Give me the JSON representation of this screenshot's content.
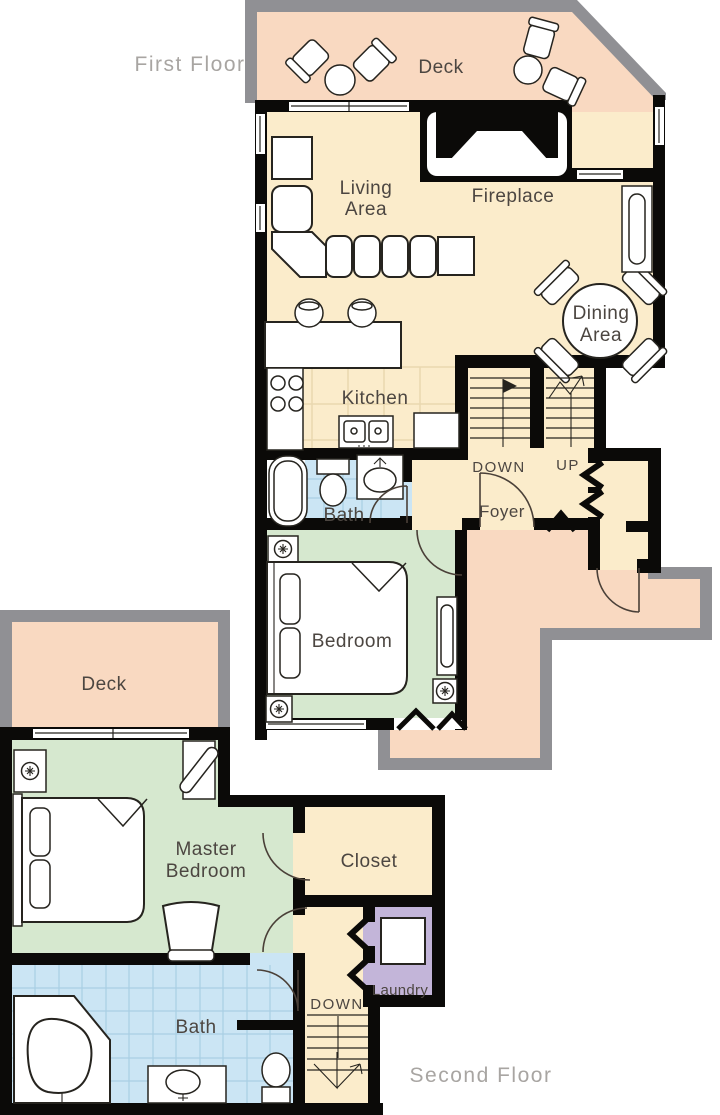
{
  "floor_labels": {
    "first": "First Floor",
    "second": "Second Floor"
  },
  "first_floor": {
    "deck": "Deck",
    "living_line1": "Living",
    "living_line2": "Area",
    "fireplace": "Fireplace",
    "dining_line1": "Dining",
    "dining_line2": "Area",
    "kitchen": "Kitchen",
    "down": "DOWN",
    "up": "UP",
    "foyer": "Foyer",
    "bath": "Bath",
    "bedroom": "Bedroom"
  },
  "second_floor": {
    "deck": "Deck",
    "master_line1": "Master",
    "master_line2": "Bedroom",
    "closet": "Closet",
    "laundry": "Laundry",
    "down": "DOWN",
    "bath": "Bath"
  },
  "colors": {
    "wall": "#0b0a08",
    "deck_peach": "#f9d9c1",
    "interior_cream": "#fbeccb",
    "bedroom_green": "#d6e8cf",
    "bath_blue": "#cbe5f4",
    "bath_tile_line": "#a9cfe3",
    "kitchen_tile_line": "#e9d8b0",
    "laundry_purple": "#c3b5d9",
    "exterior_border_gray": "#909094",
    "room_label": "#4c4641",
    "floor_label_gray": "#a8a5a2"
  }
}
